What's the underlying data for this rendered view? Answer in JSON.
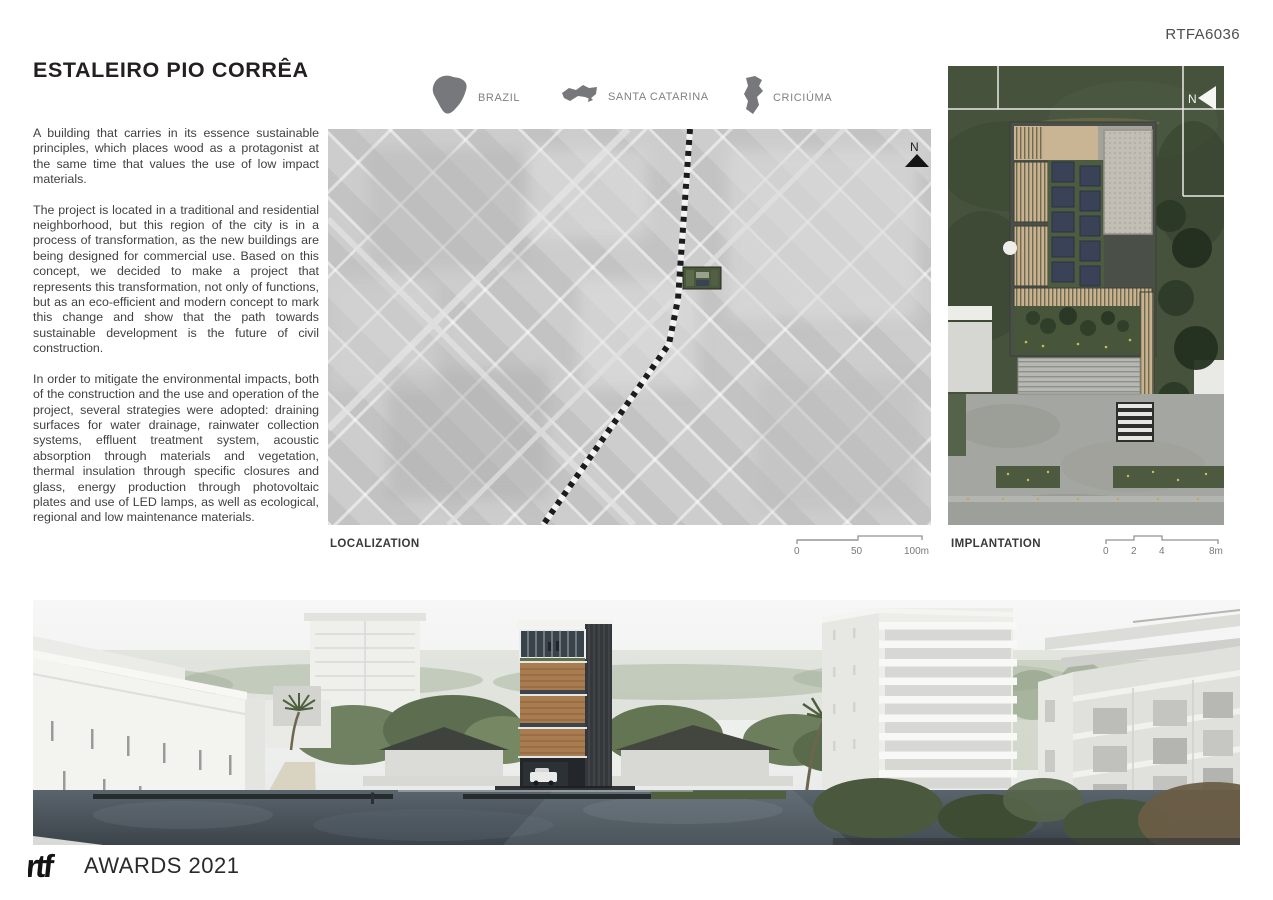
{
  "page": {
    "code": "RTFA6036"
  },
  "project": {
    "title": "ESTALEIRO PIO CORRÊA",
    "paragraphs": [
      "A building that carries in its essence sustainable principles, which places wood as a protagonist at the same time that values the use of low impact materials.",
      "The project is located in a traditional and residential neighborhood, but this region of the city is in a process of transformation, as the new buildings are being designed for commercial use. Based on this concept, we decided to make a project that represents this transformation, not only of functions, but as an eco-efficient and modern concept to mark this change and show that the path towards sustainable development is the future of civil construction.",
      "In order to mitigate the environmental impacts, both of the construction and the use and operation of the project, several strategies were adopted: draining surfaces for water drainage, rainwater collection systems, effluent treatment system, acoustic absorption through materials and vegetation, thermal insulation through specific closures and glass, energy production through photovoltaic plates and use of LED lamps, as well as ecological, regional and low maintenance materials."
    ]
  },
  "locations": [
    {
      "label": "BRAZIL"
    },
    {
      "label": "SANTA CATARINA"
    },
    {
      "label": "CRICIÚMA"
    }
  ],
  "maps": {
    "localization": {
      "label": "LOCALIZATION",
      "north": "N",
      "scale": {
        "ticks": [
          "0",
          "50",
          "100m"
        ]
      }
    },
    "implantation": {
      "label": "IMPLANTATION",
      "north": "N",
      "scale": {
        "ticks": [
          "0",
          "2",
          "4",
          "8m"
        ]
      }
    }
  },
  "footer": {
    "logo": "rtf",
    "text": "AWARDS 2021"
  },
  "colors": {
    "title_text": "#231f20",
    "body_text": "#414042",
    "muted_label": "#808184",
    "icon_gray": "#77787b",
    "map_gray": "#c9c9c9",
    "grass_green": "#46523c",
    "solar_panel": "#3a4258",
    "wood": "#a87c4e"
  }
}
